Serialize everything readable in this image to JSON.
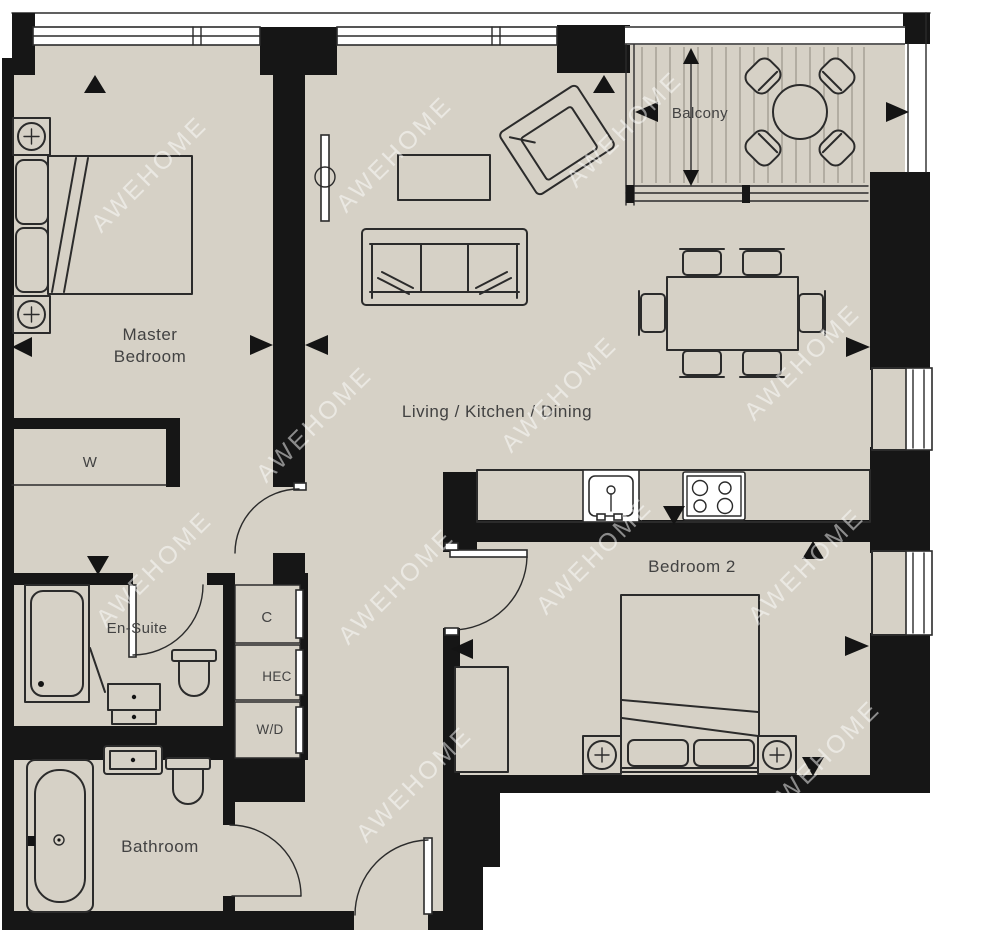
{
  "floorplan": {
    "watermark": "AWEHOME",
    "rooms": {
      "master_bedroom": {
        "line1": "Master",
        "line2": "Bedroom"
      },
      "living_kitchen_dining": {
        "label": "Living / Kitchen / Dining"
      },
      "balcony": {
        "label": "Balcony"
      },
      "bedroom_2": {
        "label": "Bedroom 2"
      },
      "en_suite": {
        "label": "En-Suite"
      },
      "bathroom": {
        "label": "Bathroom"
      }
    },
    "closets": {
      "wardrobe": "W",
      "cupboard": "C",
      "heating_cupboard": "HEC",
      "washer_dryer": "W/D"
    },
    "colors": {
      "floor": "#d6d1c6",
      "wall": "#161616",
      "line": "#2b2b2b",
      "label": "#424242"
    }
  }
}
